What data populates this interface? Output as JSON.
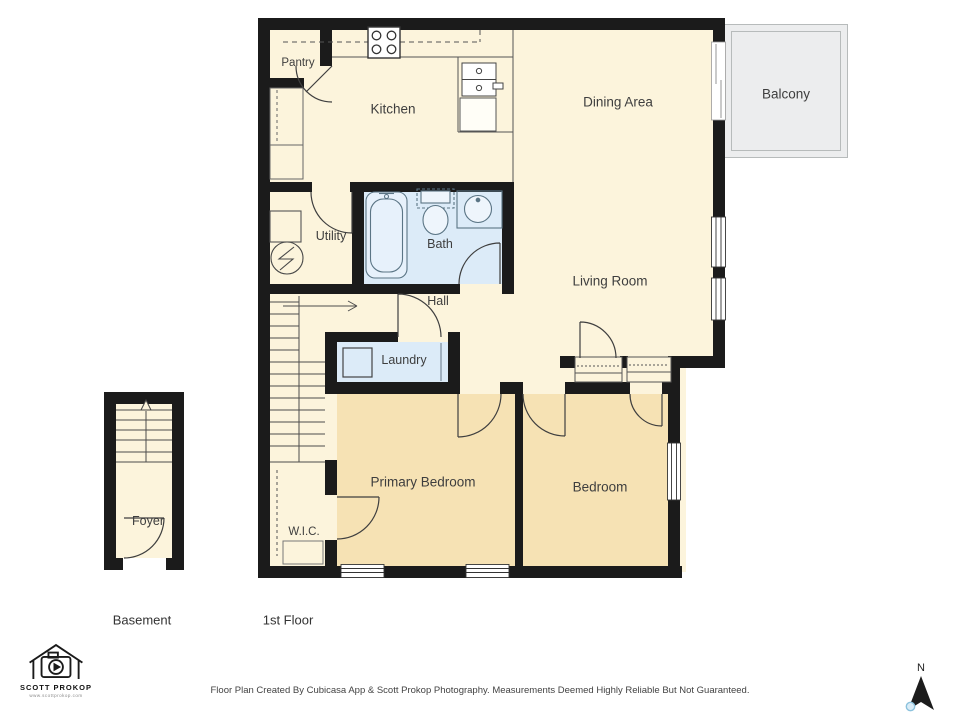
{
  "page": {
    "footer_disclaimer": "Floor Plan Created By Cubicasa App & Scott Prokop Photography. Measurements Deemed Highly Reliable But Not Guaranteed.",
    "branding": {
      "name": "SCOTT PROKOP",
      "website": "www.scottprokop.com"
    }
  },
  "floor_plan": {
    "floors": [
      {
        "label": "Basement"
      },
      {
        "label": "1st Floor"
      }
    ],
    "rooms": {
      "pantry": "Pantry",
      "kitchen": "Kitchen",
      "dining": "Dining Area",
      "balcony": "Balcony",
      "utility": "Utility",
      "bath": "Bath",
      "living": "Living Room",
      "hall": "Hall",
      "laundry": "Laundry",
      "primary_bedroom": "Primary Bedroom",
      "bedroom": "Bedroom",
      "wic": "W.I.C.",
      "foyer": "Foyer"
    },
    "compass": {
      "north_label": "N"
    },
    "colors": {
      "wall": "#1b1b1b",
      "floor_cream": "#fcf4dc",
      "bedroom_tan": "#f6e2b4",
      "wet_room_blue": "#dcebf8",
      "balcony_gray": "#ecedee"
    }
  }
}
